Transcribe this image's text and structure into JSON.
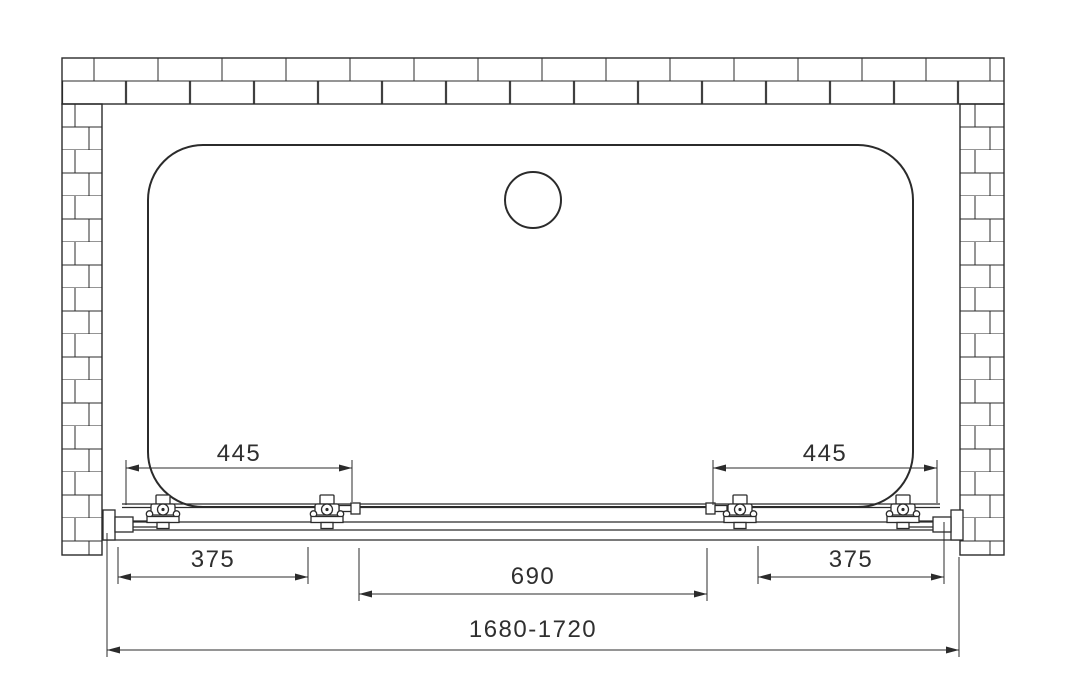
{
  "drawing": {
    "subject": "Sliding shower door enclosure - top view installation drawing",
    "units": "mm",
    "colors": {
      "line": "#2b2b2b",
      "background": "#ffffff",
      "dim_text": "#2f2f2f"
    },
    "dimensions": {
      "left_door": "445",
      "right_door": "445",
      "left_panel": "375",
      "center_opening": "690",
      "right_panel": "375",
      "overall_width": "1680-1720"
    },
    "components": {
      "wall": "brick-wall",
      "tray": "shower-tray",
      "drain": "drain",
      "track": "door-track",
      "rollers": "roller-assemblies"
    }
  }
}
